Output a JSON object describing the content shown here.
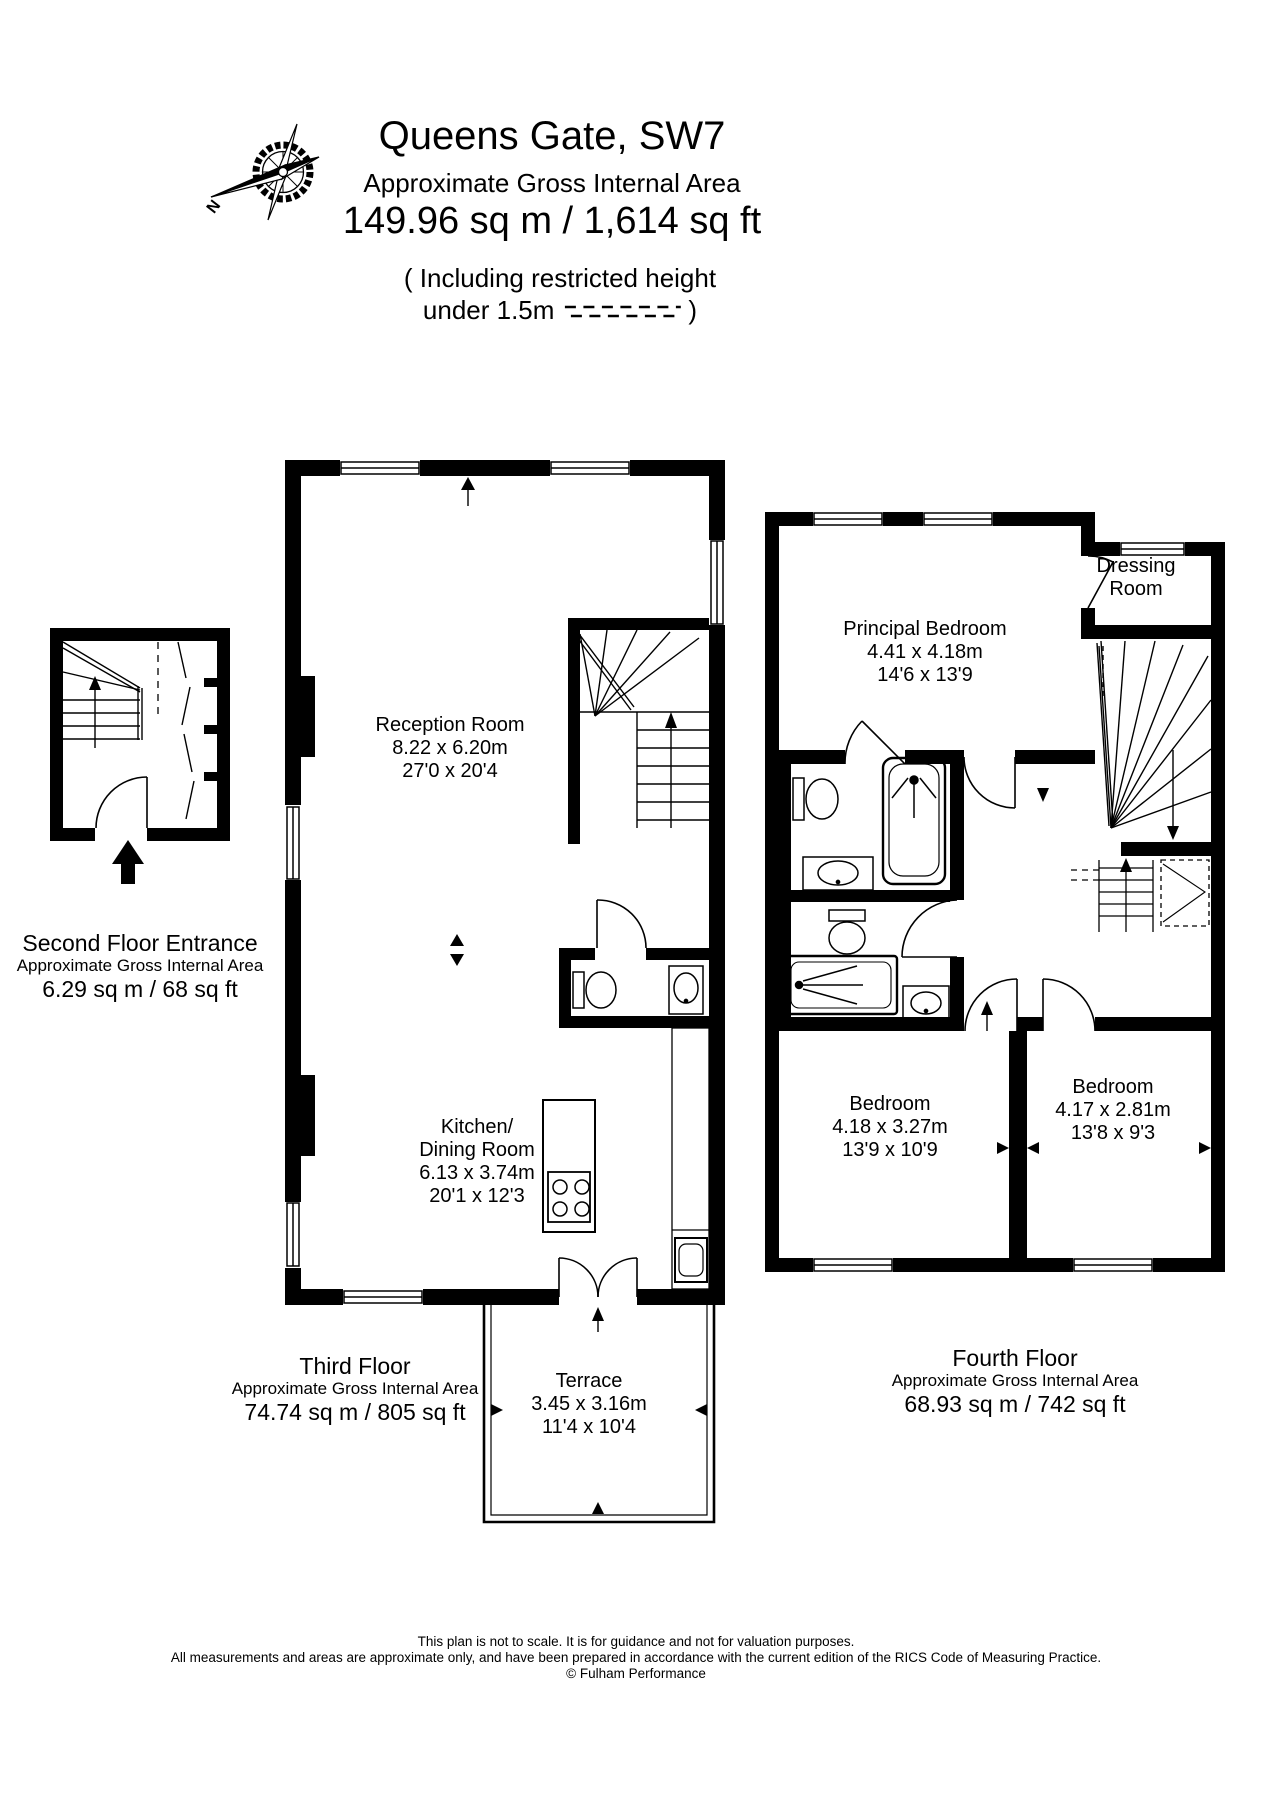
{
  "header": {
    "title": "Queens Gate, SW7",
    "subtitle": "Approximate Gross Internal Area",
    "area": "149.96 sq m  /  1,614 sq ft",
    "note_line1": "( Including restricted height",
    "note_line2": "under 1.5m",
    "note_close": ")",
    "compass_label": "N"
  },
  "floors": {
    "second": {
      "name": "Second Floor Entrance",
      "subtitle": "Approximate Gross Internal Area",
      "area": "6.29 sq m  /  68 sq ft"
    },
    "third": {
      "name": "Third Floor",
      "subtitle": "Approximate Gross Internal Area",
      "area": "74.74 sq m  /  805 sq ft"
    },
    "fourth": {
      "name": "Fourth Floor",
      "subtitle": "Approximate Gross Internal Area",
      "area": "68.93 sq m  /  742 sq ft"
    }
  },
  "rooms": {
    "reception": {
      "name": "Reception Room",
      "metric": "8.22 x 6.20m",
      "imperial": "27'0 x 20'4"
    },
    "kitchen": {
      "name_line1": "Kitchen/",
      "name_line2": "Dining Room",
      "metric": "6.13 x 3.74m",
      "imperial": "20'1 x 12'3"
    },
    "terrace": {
      "name": "Terrace",
      "metric": "3.45 x 3.16m",
      "imperial": "11'4 x 10'4"
    },
    "principal_bedroom": {
      "name": "Principal Bedroom",
      "metric": "4.41 x 4.18m",
      "imperial": "14'6 x 13'9"
    },
    "dressing_room": {
      "name_line1": "Dressing",
      "name_line2": "Room"
    },
    "bedroom_left": {
      "name": "Bedroom",
      "metric": "4.18 x 3.27m",
      "imperial": "13'9 x 10'9"
    },
    "bedroom_right": {
      "name": "Bedroom",
      "metric": "4.17 x 2.81m",
      "imperial": "13'8 x 9'3"
    }
  },
  "footer": {
    "line1": "This plan is not to scale. It is for guidance and not for valuation purposes.",
    "line2": "All measurements and areas are approximate only, and have been prepared in accordance with the current edition of the RICS Code of Measuring Practice.",
    "line3": "© Fulham Performance"
  },
  "colors": {
    "ink": "#000000",
    "background": "#ffffff"
  }
}
